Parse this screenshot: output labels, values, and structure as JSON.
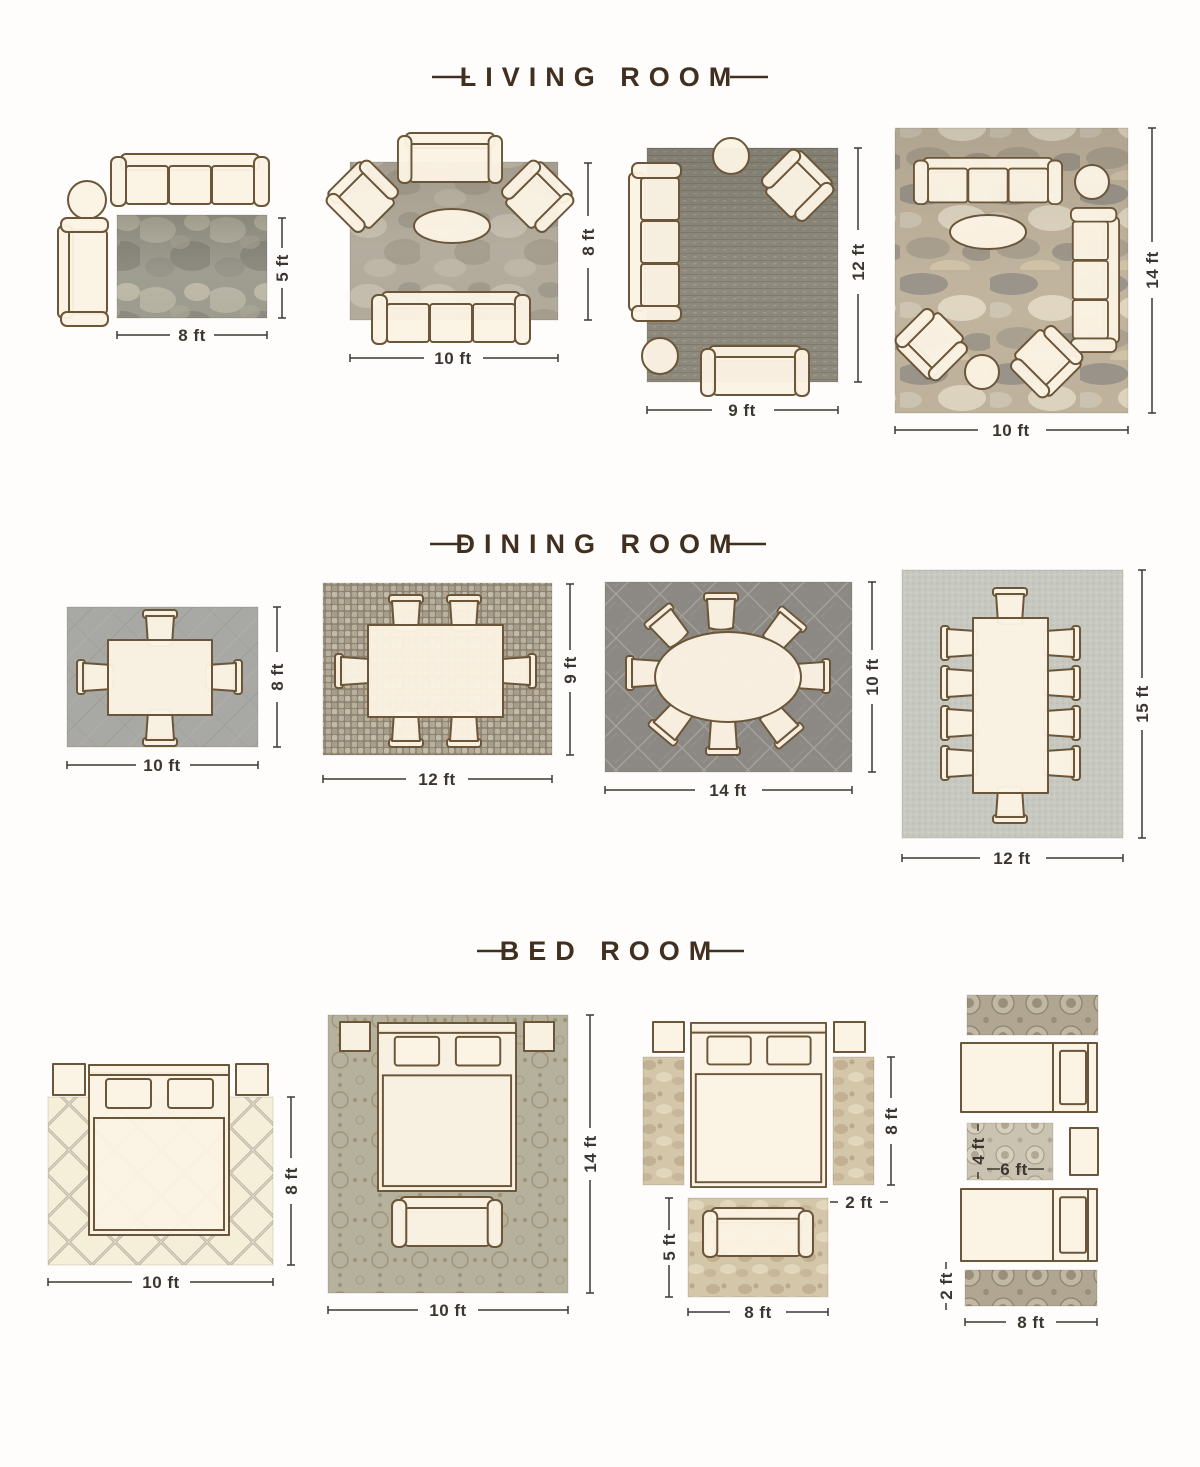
{
  "page": {
    "background": "#fefdfb",
    "title_color": "#41301f",
    "dimension_color": "#3b3631",
    "furniture_fill": "#fbf2e3",
    "furniture_stroke": "#6b5639"
  },
  "sections": [
    {
      "title": "LIVING ROOM",
      "layouts": [
        {
          "id": "living-1",
          "rug_width": "8 ft",
          "rug_height": "5 ft"
        },
        {
          "id": "living-2",
          "rug_width": "10 ft",
          "rug_height": "8 ft"
        },
        {
          "id": "living-3",
          "rug_width": "9 ft",
          "rug_height": "12 ft"
        },
        {
          "id": "living-4",
          "rug_width": "10 ft",
          "rug_height": "14 ft"
        }
      ]
    },
    {
      "title": "DINING ROOM",
      "layouts": [
        {
          "id": "dining-1",
          "rug_width": "10 ft",
          "rug_height": "8 ft"
        },
        {
          "id": "dining-2",
          "rug_width": "12 ft",
          "rug_height": "9 ft"
        },
        {
          "id": "dining-3",
          "rug_width": "14 ft",
          "rug_height": "10 ft"
        },
        {
          "id": "dining-4",
          "rug_width": "12 ft",
          "rug_height": "15 ft"
        }
      ]
    },
    {
      "title": "BED ROOM",
      "layouts": [
        {
          "id": "bed-1",
          "rug_width": "10 ft",
          "rug_height": "8 ft"
        },
        {
          "id": "bed-2",
          "rug_width": "10 ft",
          "rug_height": "14 ft"
        },
        {
          "id": "bed-3",
          "runner_height": "8 ft",
          "runner_width": "2 ft",
          "foot_rug_height": "5 ft",
          "foot_rug_width": "8 ft"
        },
        {
          "id": "bed-4",
          "center_rug_height": "4 ft",
          "center_rug_width": "6 ft",
          "runner_height": "2 ft",
          "bed_area_width": "8 ft"
        }
      ]
    }
  ]
}
